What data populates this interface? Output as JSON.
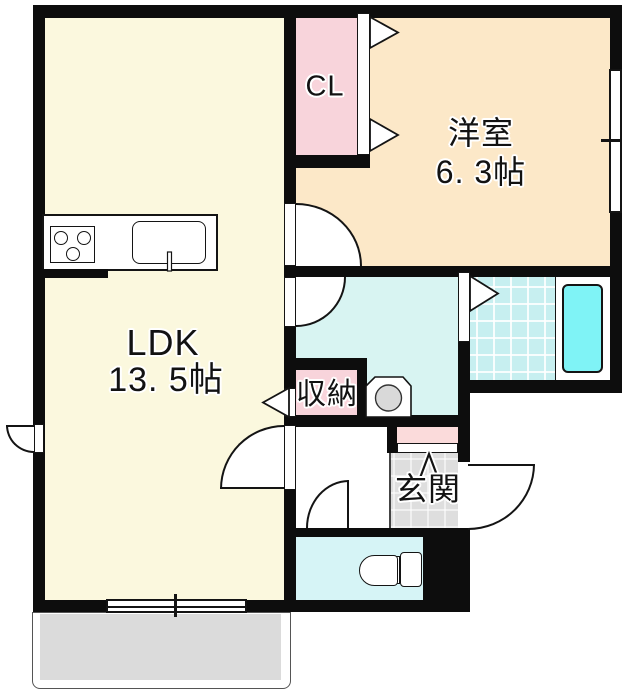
{
  "plan_title": "1LDK floor plan",
  "rooms": {
    "ldk": {
      "label": "LDK",
      "size": "13. 5帖",
      "color": "#fbf8de"
    },
    "western": {
      "label": "洋室",
      "size": "6. 3帖",
      "color": "#fce8c8"
    },
    "closet": {
      "label": "CL",
      "color": "#f8d4db"
    },
    "storage": {
      "label": "収納",
      "color": "#f8d4db"
    },
    "entrance": {
      "label": "玄関",
      "color": "#dedede"
    },
    "washroom": {
      "color": "#d8f4f2"
    },
    "bathroom": {
      "color": "#c7eff0",
      "tub_color": "#7ff3f6"
    },
    "toilet_room": {
      "color": "#d6f4f6"
    },
    "balcony": {
      "color": "#dbdbdb"
    },
    "shoe_cabinet": {
      "color": "#fbdbdb"
    }
  },
  "colors": {
    "wall": "#0d0d0d",
    "outline": "#141414"
  },
  "icons": {
    "stove": "stove-icon",
    "sink": "sink-icon",
    "faucet": "faucet-icon",
    "washing_machine": "washing-machine-icon",
    "toilet": "toilet-icon",
    "bathtub": "bathtub-icon",
    "entry_step": "entry-step-arrow-icon"
  }
}
